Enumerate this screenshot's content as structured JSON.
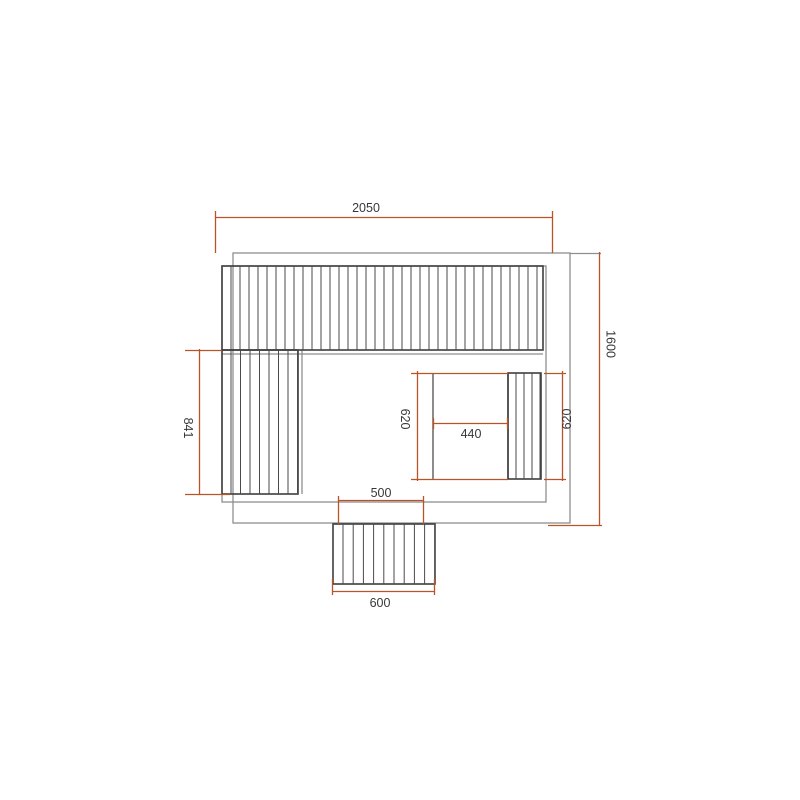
{
  "drawing": {
    "dims": {
      "overall_width": "2050",
      "overall_depth": "1600",
      "left_bench_length": "841",
      "alcove_depth_left": "620",
      "heater_width": "440",
      "alcove_depth_right": "620",
      "door_opening_width": "500",
      "step_width": "600"
    },
    "colors": {
      "background": "#ffffff",
      "dimension_line": "#bb5329",
      "wall_line": "#8e8e8e",
      "bench_line": "#3e3e3e",
      "hatch_line": "#4a4a4a",
      "label_text": "#383838"
    }
  }
}
